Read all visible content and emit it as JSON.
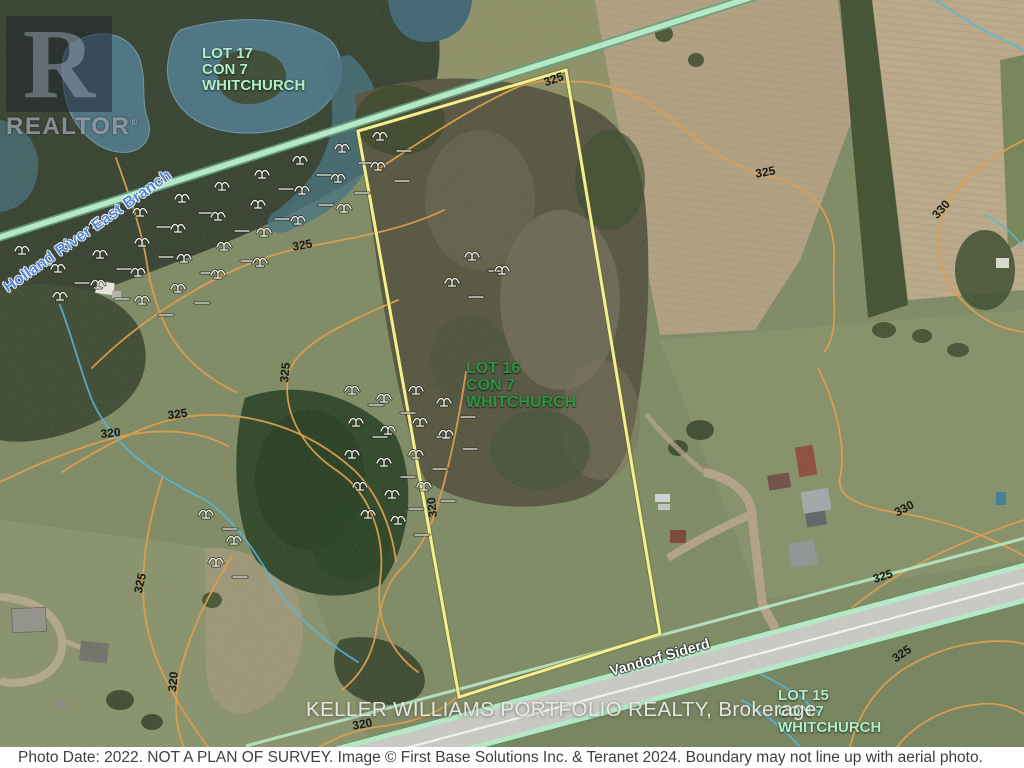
{
  "watermark": {
    "letter": "R",
    "text": "REALTOR",
    "registered": "®"
  },
  "lots": {
    "lot17": {
      "lines": [
        "LOT 17",
        "CON 7",
        "WHITCHURCH"
      ]
    },
    "lot16": {
      "lines": [
        "LOT 16",
        "CON 7",
        "WHITCHURCH"
      ]
    },
    "lot15": {
      "lines": [
        "LOT 15",
        "CON 7",
        "WHITCHURCH"
      ]
    }
  },
  "labels": {
    "river": "Holland River East Branch",
    "road": "Vandorf Siderd",
    "brokerage": "KELLER WILLIAMS PORTFOLIO REALTY, Brokerage",
    "footer": "Photo Date: 2022. NOT A PLAN OF SURVEY. Image © First Base Solutions Inc. & Teranet 2024. Boundary may not line up with aerial photo."
  },
  "contour_labels": [
    {
      "v": "325",
      "x": 555,
      "y": 83,
      "r": -20
    },
    {
      "v": "325",
      "x": 766,
      "y": 176,
      "r": -10
    },
    {
      "v": "330",
      "x": 944,
      "y": 212,
      "r": -48
    },
    {
      "v": "325",
      "x": 303,
      "y": 249,
      "r": -10
    },
    {
      "v": "325",
      "x": 289,
      "y": 373,
      "r": -84
    },
    {
      "v": "325",
      "x": 178,
      "y": 418,
      "r": -8
    },
    {
      "v": "320",
      "x": 111,
      "y": 437,
      "r": -6
    },
    {
      "v": "320",
      "x": 436,
      "y": 507,
      "r": -96
    },
    {
      "v": "325",
      "x": 144,
      "y": 584,
      "r": -78
    },
    {
      "v": "320",
      "x": 177,
      "y": 682,
      "r": -85
    },
    {
      "v": "330",
      "x": 906,
      "y": 512,
      "r": -28
    },
    {
      "v": "325",
      "x": 884,
      "y": 580,
      "r": -18
    },
    {
      "v": "325",
      "x": 904,
      "y": 657,
      "r": -35
    },
    {
      "v": "320",
      "x": 363,
      "y": 728,
      "r": -10
    }
  ],
  "wetland_symbols": [
    [
      22,
      250
    ],
    [
      58,
      268
    ],
    [
      96,
      224
    ],
    [
      100,
      254
    ],
    [
      98,
      284
    ],
    [
      60,
      296
    ],
    [
      140,
      212
    ],
    [
      142,
      242
    ],
    [
      138,
      272
    ],
    [
      142,
      300
    ],
    [
      182,
      198
    ],
    [
      178,
      228
    ],
    [
      184,
      258
    ],
    [
      178,
      288
    ],
    [
      222,
      186
    ],
    [
      218,
      216
    ],
    [
      224,
      246
    ],
    [
      218,
      274
    ],
    [
      262,
      174
    ],
    [
      258,
      204
    ],
    [
      264,
      232
    ],
    [
      300,
      160
    ],
    [
      302,
      190
    ],
    [
      298,
      220
    ],
    [
      342,
      148
    ],
    [
      338,
      178
    ],
    [
      344,
      208
    ],
    [
      380,
      136
    ],
    [
      378,
      166
    ],
    [
      260,
      262
    ],
    [
      352,
      390
    ],
    [
      384,
      398
    ],
    [
      416,
      390
    ],
    [
      444,
      402
    ],
    [
      356,
      422
    ],
    [
      388,
      430
    ],
    [
      420,
      422
    ],
    [
      446,
      434
    ],
    [
      352,
      454
    ],
    [
      384,
      462
    ],
    [
      416,
      454
    ],
    [
      360,
      486
    ],
    [
      392,
      494
    ],
    [
      424,
      486
    ],
    [
      368,
      514
    ],
    [
      398,
      520
    ],
    [
      206,
      514
    ],
    [
      234,
      540
    ],
    [
      216,
      562
    ],
    [
      472,
      256
    ],
    [
      502,
      270
    ],
    [
      452,
      282
    ]
  ],
  "colors": {
    "boundary": "#f3ee8e",
    "contour": "#dd9e4f",
    "roadEdge": "#b7e8c6",
    "stream": "#56b8dc",
    "lotLight": "#b3eeca",
    "lotDark": "#2f9242",
    "footerBg": "#ffffff",
    "footerText": "#3f3f3f"
  }
}
